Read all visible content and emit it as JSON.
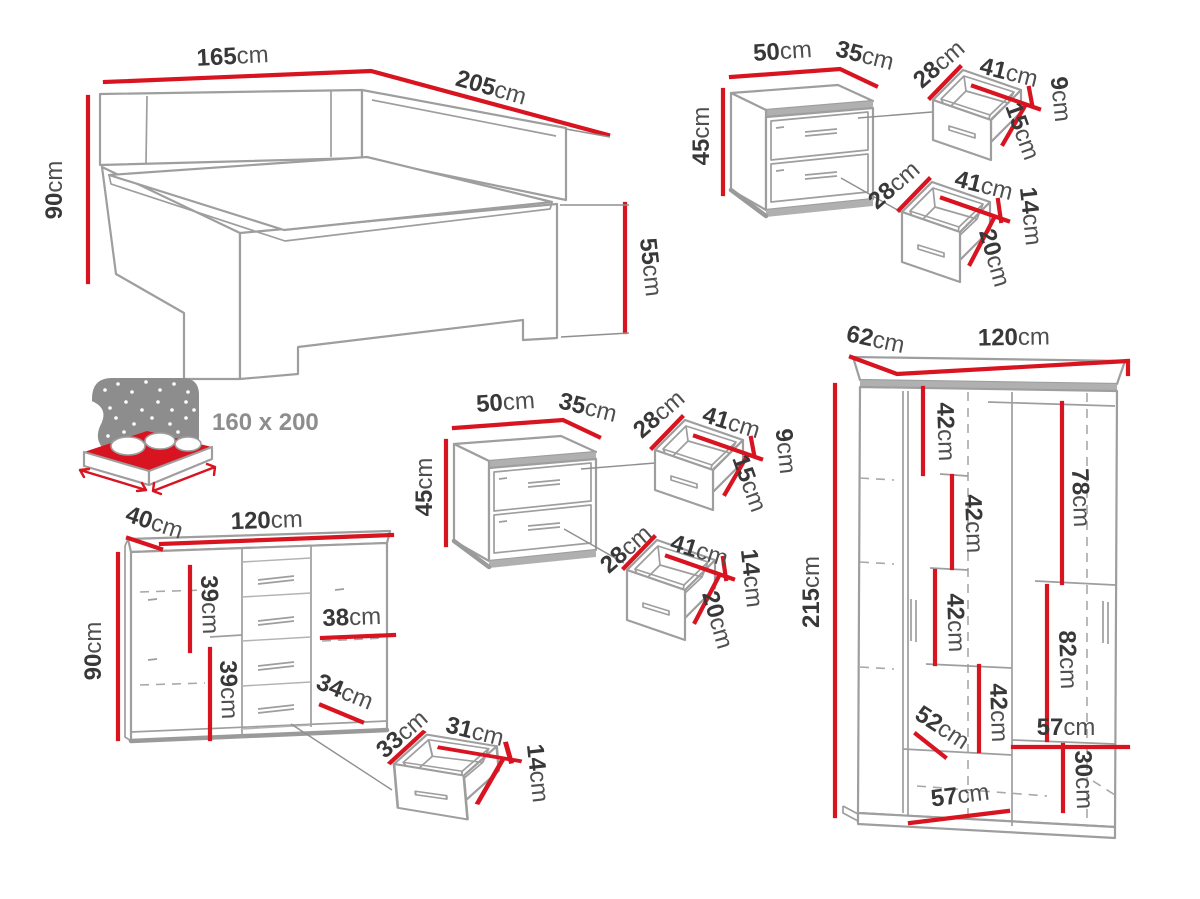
{
  "units": {
    "cm": "cm"
  },
  "colors": {
    "dimension": "#d81420",
    "outline": "#9e9e9e",
    "text": "#383838",
    "unit_text": "#4f4f4f",
    "icon_grey": "#8d8d8d"
  },
  "bed": {
    "width": "165",
    "length": "205",
    "height": "90",
    "footboard_height": "55",
    "mattress_size": "160 x 200"
  },
  "nightstand_top": {
    "width": "50",
    "depth": "35",
    "height": "45",
    "drawer_small": {
      "depth": "28",
      "width": "41",
      "back_height": "9",
      "front_height": "15"
    },
    "drawer_large": {
      "depth": "28",
      "width": "41",
      "back_height": "14",
      "front_height": "20"
    }
  },
  "nightstand_middle": {
    "width": "50",
    "depth": "35",
    "height": "45",
    "drawer_small": {
      "depth": "28",
      "width": "41",
      "back_height": "9",
      "front_height": "15"
    },
    "drawer_large": {
      "depth": "28",
      "width": "41",
      "back_height": "14",
      "front_height": "20"
    }
  },
  "dresser": {
    "depth": "40",
    "width": "120",
    "height": "90",
    "shelf_spacing_top": "39",
    "shelf_spacing_bottom": "39",
    "inner_width": "38",
    "inner_depth": "34",
    "drawer": {
      "depth": "33",
      "width": "31",
      "height": "14"
    }
  },
  "wardrobe": {
    "depth": "62",
    "width": "120",
    "height": "215",
    "shelves": [
      "42",
      "42",
      "42",
      "42"
    ],
    "hanging_top": "78",
    "hanging_bottom": "82",
    "inner_depth": "52",
    "inner_width_right": "57",
    "bottom_height": "30",
    "inner_width_left": "57"
  }
}
